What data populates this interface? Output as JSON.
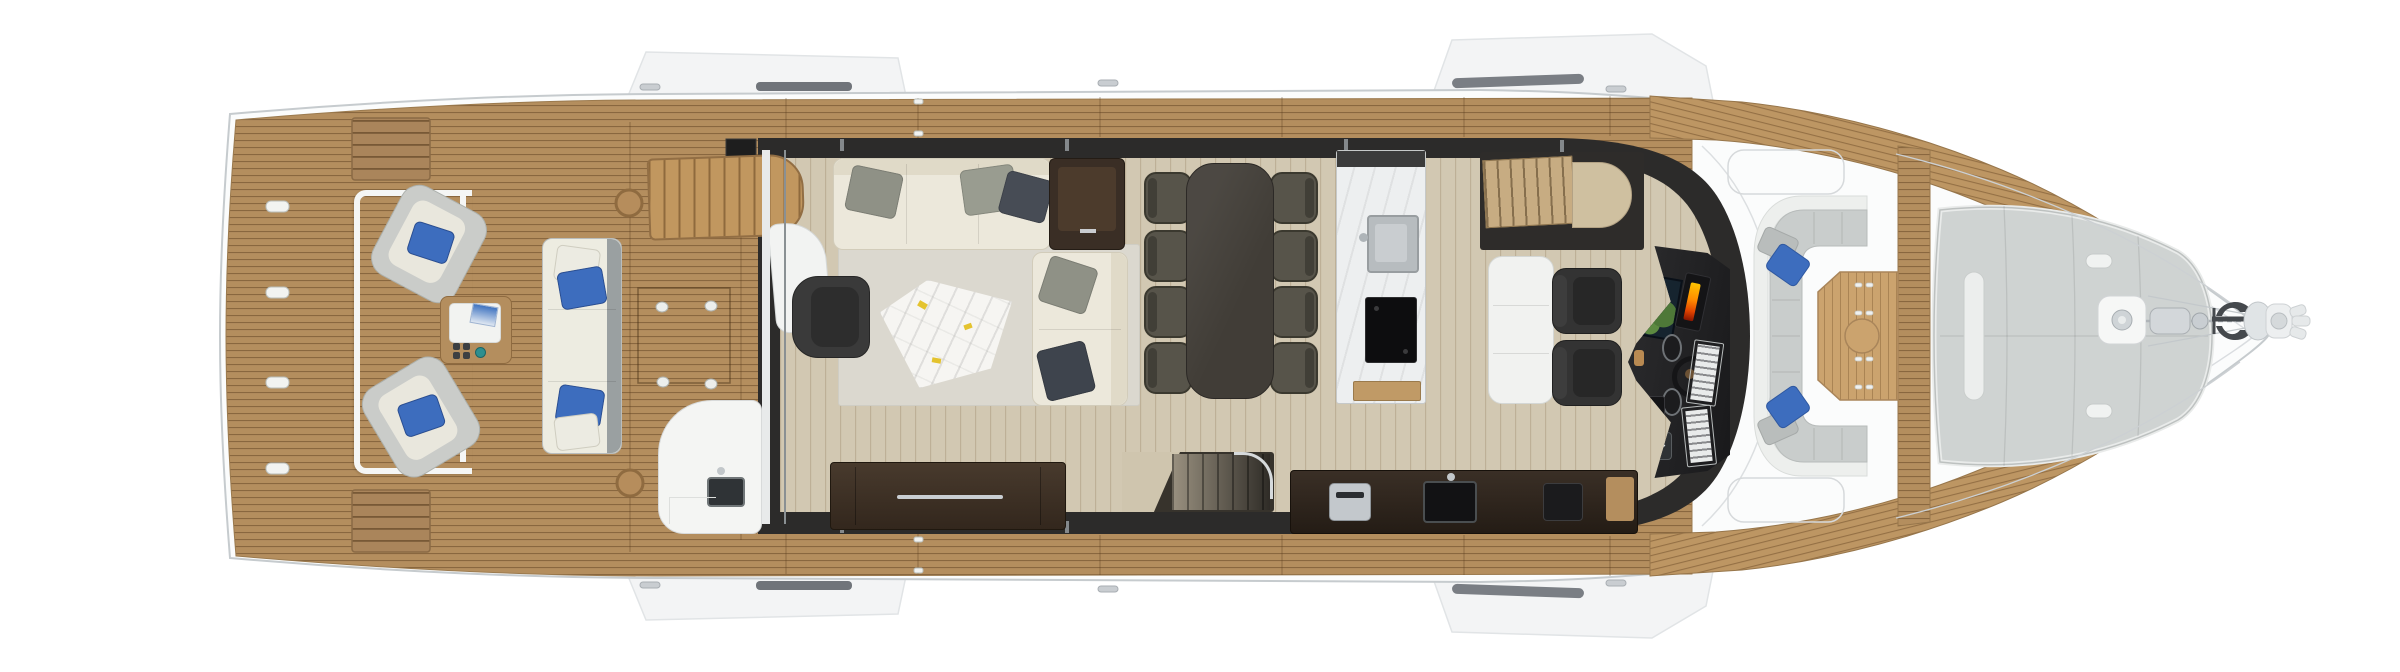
{
  "meta": {
    "kind": "yacht main-deck floor plan, top-down 3D render",
    "orientation": "bow to the right, stern to the left"
  },
  "palette": {
    "hull": "#fbfcfc",
    "hull_line": "#c6cbce",
    "deck_line": "#dcdfe1",
    "teak": "#b48e5e",
    "teak_light": "#bd9663",
    "teak_pale": "#cba36e",
    "cabin": "#2c2b2a",
    "floor": "#d2c8b2",
    "carpet": "#dbd8cf",
    "cream": "#ece8db",
    "cream_dark": "#e0dac8",
    "pillow_gray": "#b9bdbc",
    "sofa_gray": "#8f9186",
    "navy": "#474c55",
    "blue": "#3d6dbe",
    "teal": "#2e8f8f",
    "marble": "#f6f5f2",
    "gold_fleck": "#e4c32e",
    "walnut": "#3b2f26",
    "chair_gray": "#57544a",
    "lounge_gray": "#c9cdcc",
    "sunpad_gray": "#cfd3d2",
    "white_trim": "#edefed",
    "chrome": "#c9ced2",
    "screen_navy": "#16242f",
    "screen_green": "#4e7838",
    "display_orange": "#ff8a00"
  },
  "areas": {
    "swim_platform": {
      "label": "teak swim platform",
      "flush_hatches": 4
    },
    "aft_deck": {
      "label": "aft cockpit",
      "swivel_armchairs": 2,
      "armchair_pillow_color": "blue",
      "sofa": {
        "seats": 3,
        "blue_pillows": 2,
        "white_pillows": 2
      },
      "cocktail_table": {
        "tray": true,
        "magazine": true,
        "dark_cups": 4,
        "teal_cup": 1
      },
      "wet_bar_sink": 1,
      "flybridge_stairs": 1,
      "table_sockets": 4
    },
    "salon": {
      "label": "main salon",
      "long_sofa_pillows": 3,
      "loveseat_pillows": 2,
      "coffee_table": "white marble with gold flecks",
      "armchair": 1,
      "sideboard": 1,
      "end_table": 1
    },
    "dining": {
      "label": "dining area",
      "table": "dark wood",
      "chairs": 8
    },
    "galley": {
      "label": "galley",
      "island": [
        "marble worktop",
        "sink",
        "cooktop"
      ],
      "starboard_counter": [
        "espresso machine",
        "sink",
        "appliance"
      ],
      "stairs_down": 1,
      "port_stairs": 1
    },
    "helm": {
      "label": "helm station",
      "seats": 2,
      "companion_settee": 1,
      "displays": [
        "chart plotter",
        "engine display",
        "instrument panel",
        "instrument panel"
      ],
      "wheel": 1,
      "keypad": 1
    },
    "bow": {
      "label": "bow lounge",
      "u_lounge": {
        "blue_pillows": 2,
        "gray_pillows": 2
      },
      "teak_table": 1,
      "sunpad": 1,
      "windlass": 1,
      "anchor": 1
    }
  }
}
